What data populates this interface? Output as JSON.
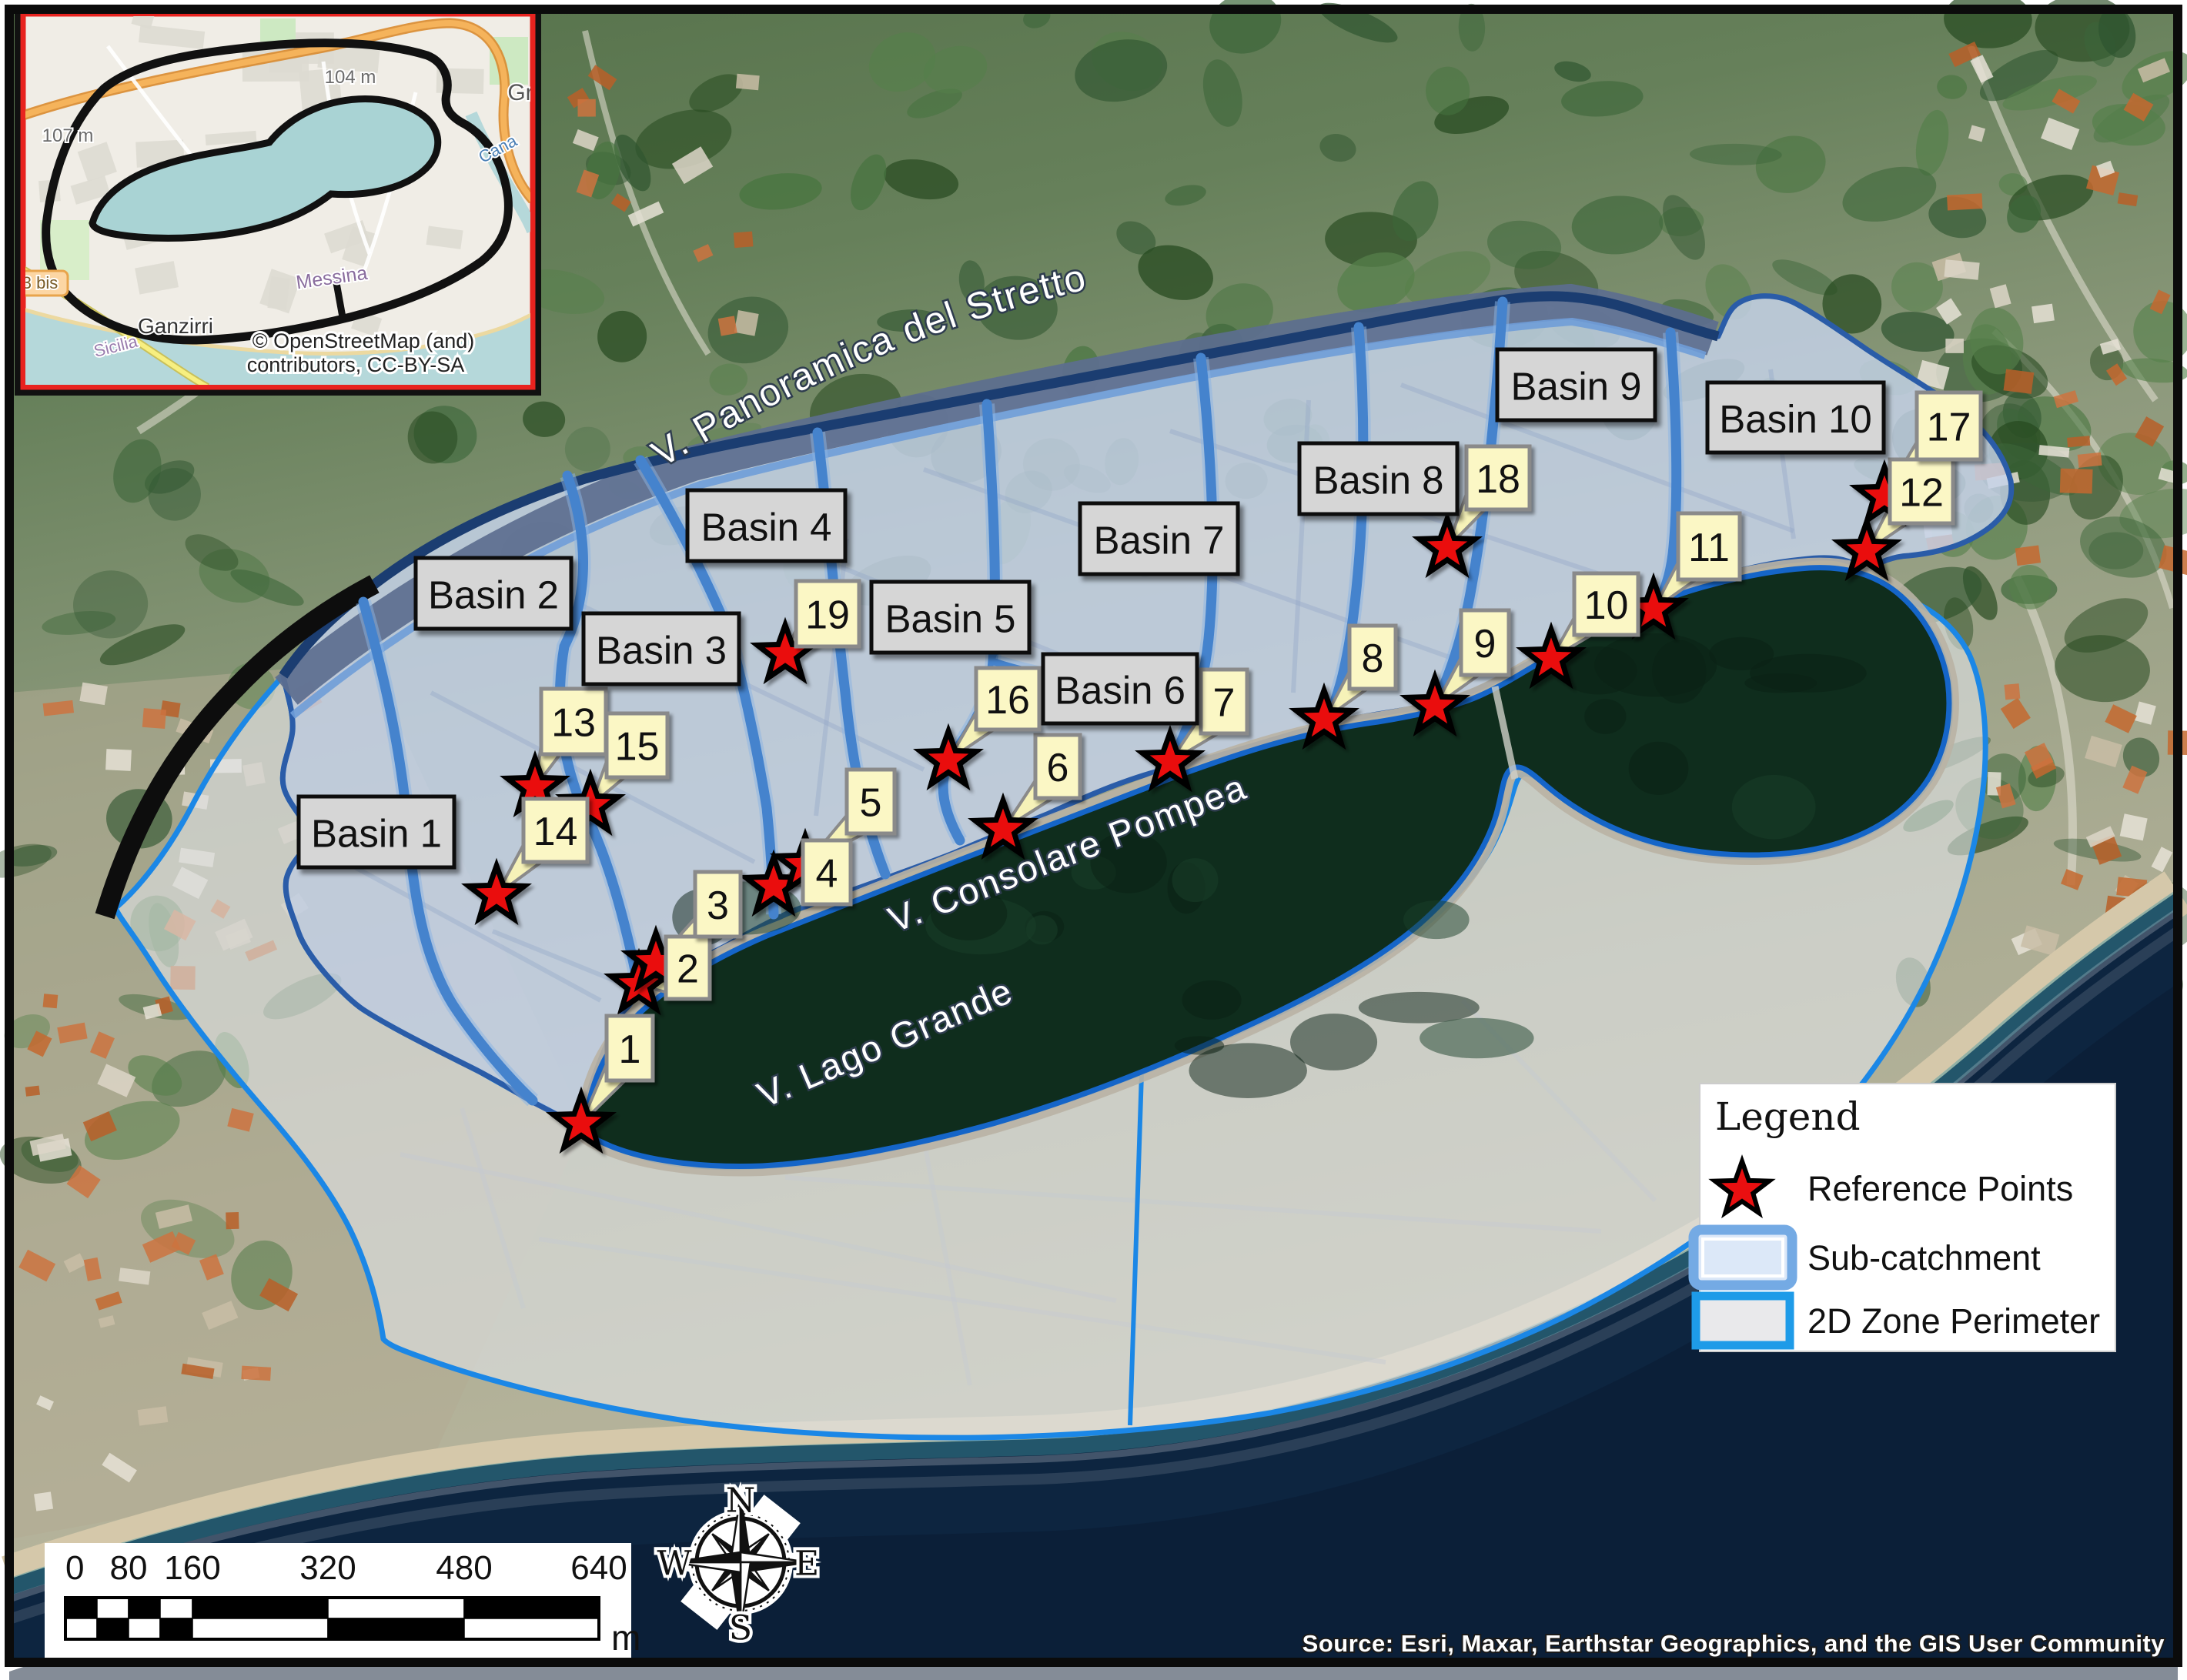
{
  "map": {
    "basins": [
      {
        "id": 1,
        "label": "Basin 1"
      },
      {
        "id": 2,
        "label": "Basin 2"
      },
      {
        "id": 3,
        "label": "Basin 3"
      },
      {
        "id": 4,
        "label": "Basin 4"
      },
      {
        "id": 5,
        "label": "Basin 5"
      },
      {
        "id": 6,
        "label": "Basin 6"
      },
      {
        "id": 7,
        "label": "Basin 7"
      },
      {
        "id": 8,
        "label": "Basin 8"
      },
      {
        "id": 9,
        "label": "Basin 9"
      },
      {
        "id": 10,
        "label": "Basin 10"
      }
    ],
    "reference_points": [
      {
        "id": 1,
        "label": "1"
      },
      {
        "id": 2,
        "label": "2"
      },
      {
        "id": 3,
        "label": "3"
      },
      {
        "id": 4,
        "label": "4"
      },
      {
        "id": 5,
        "label": "5"
      },
      {
        "id": 6,
        "label": "6"
      },
      {
        "id": 7,
        "label": "7"
      },
      {
        "id": 8,
        "label": "8"
      },
      {
        "id": 9,
        "label": "9"
      },
      {
        "id": 10,
        "label": "10"
      },
      {
        "id": 11,
        "label": "11"
      },
      {
        "id": 12,
        "label": "12"
      },
      {
        "id": 13,
        "label": "13"
      },
      {
        "id": 14,
        "label": "14"
      },
      {
        "id": 15,
        "label": "15"
      },
      {
        "id": 16,
        "label": "16"
      },
      {
        "id": 17,
        "label": "17"
      },
      {
        "id": 18,
        "label": "18"
      },
      {
        "id": 19,
        "label": "19"
      }
    ],
    "roads": [
      {
        "name": "V. Panoramica del Stretto"
      },
      {
        "name": "V. Consolare Pompea"
      },
      {
        "name": "V. Lago Grande"
      }
    ]
  },
  "legend": {
    "title": "Legend",
    "items": [
      {
        "symbol": "star-icon",
        "label": "Reference Points"
      },
      {
        "symbol": "sub-catchment-swatch",
        "label": "Sub-catchment"
      },
      {
        "symbol": "2d-zone-swatch",
        "label": "2D Zone Perimeter"
      }
    ]
  },
  "scale_bar": {
    "tick_labels": [
      "0",
      "80",
      "160",
      "320",
      "480",
      "640"
    ],
    "unit": "m"
  },
  "compass": {
    "north": "N",
    "east": "E",
    "south": "S",
    "west": "W"
  },
  "source_credit": "Source: Esri, Maxar, Earthstar Geographics, and the GIS User Community",
  "inset": {
    "attribution_line1": "© OpenStreetMap (and)",
    "attribution_line2": "contributors, CC-BY-SA",
    "labels": [
      {
        "text": "104 m"
      },
      {
        "text": "107 m"
      },
      {
        "text": "Gr"
      },
      {
        "text": "Cana"
      },
      {
        "text": "3 bis"
      },
      {
        "text": "Ganzirri"
      },
      {
        "text": "Messina"
      },
      {
        "text": "Sicilia"
      }
    ]
  },
  "colors": {
    "reference_point": "#e8000d",
    "sub_catchment_fill": "#c6d3ea",
    "sub_catchment_border": "#2a5ca8",
    "divider_blue": "#4583cd",
    "zone_border": "#1b87e6",
    "zone_fill": "#e1e4e8",
    "lake": "#0f2d1d",
    "sea": "#0e2238",
    "label_box": "#fbf7c5",
    "basin_box": "#d6d6d6"
  }
}
